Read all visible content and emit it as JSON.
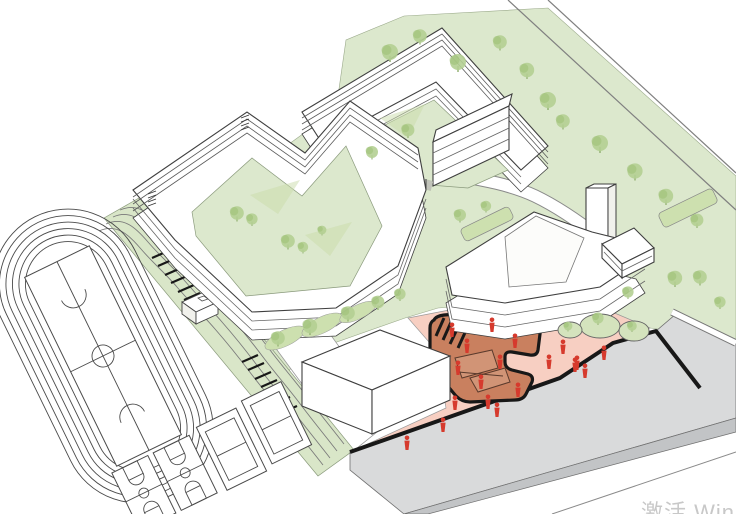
{
  "meta": {
    "kind": "architectural axonometric campus masterplan illustration",
    "view": "axonometric line drawing with green landscape, white buildings, red entry plaza"
  },
  "watermark": {
    "text": "激活 Win"
  },
  "palette": {
    "bg": "#ffffff",
    "line": "#3f3f3f",
    "line_strong": "#181818",
    "lawn": "#dce8cd",
    "terrace": "#d9e6c8",
    "tree": "#b4cf92",
    "tree_dark": "#9dbf75",
    "hedge": "#cde0af",
    "shadow_green": "#c9dcaa",
    "plaza_pink": "#f7cfc2",
    "plaza_terracotta": "#c9805f",
    "terracotta_light": "#d39b7e",
    "figure_red": "#d63a2d",
    "road_gray": "#d9dadb",
    "road_side": "#c2c4c6",
    "building_white": "#ffffff",
    "wall_tint": "#f1f1ec",
    "watermark": "#c8c8c8"
  },
  "scene": {
    "running_track_lanes": 6,
    "basketball_courts": 2,
    "multiuse_courts": 2,
    "buildings": [
      "courtyard-teaching-building",
      "north-u-building",
      "mid-rise-slab",
      "hall-building-with-tower",
      "gymnasium-box",
      "east-pavilion"
    ],
    "trees_count": 31,
    "pedestrian_figures_count": 19,
    "features": [
      "terraced-green-steps",
      "stair-hatches",
      "kiosk",
      "sunken-orange-playground",
      "pink-entry-plaza",
      "gray-street",
      "boundary-road"
    ]
  }
}
